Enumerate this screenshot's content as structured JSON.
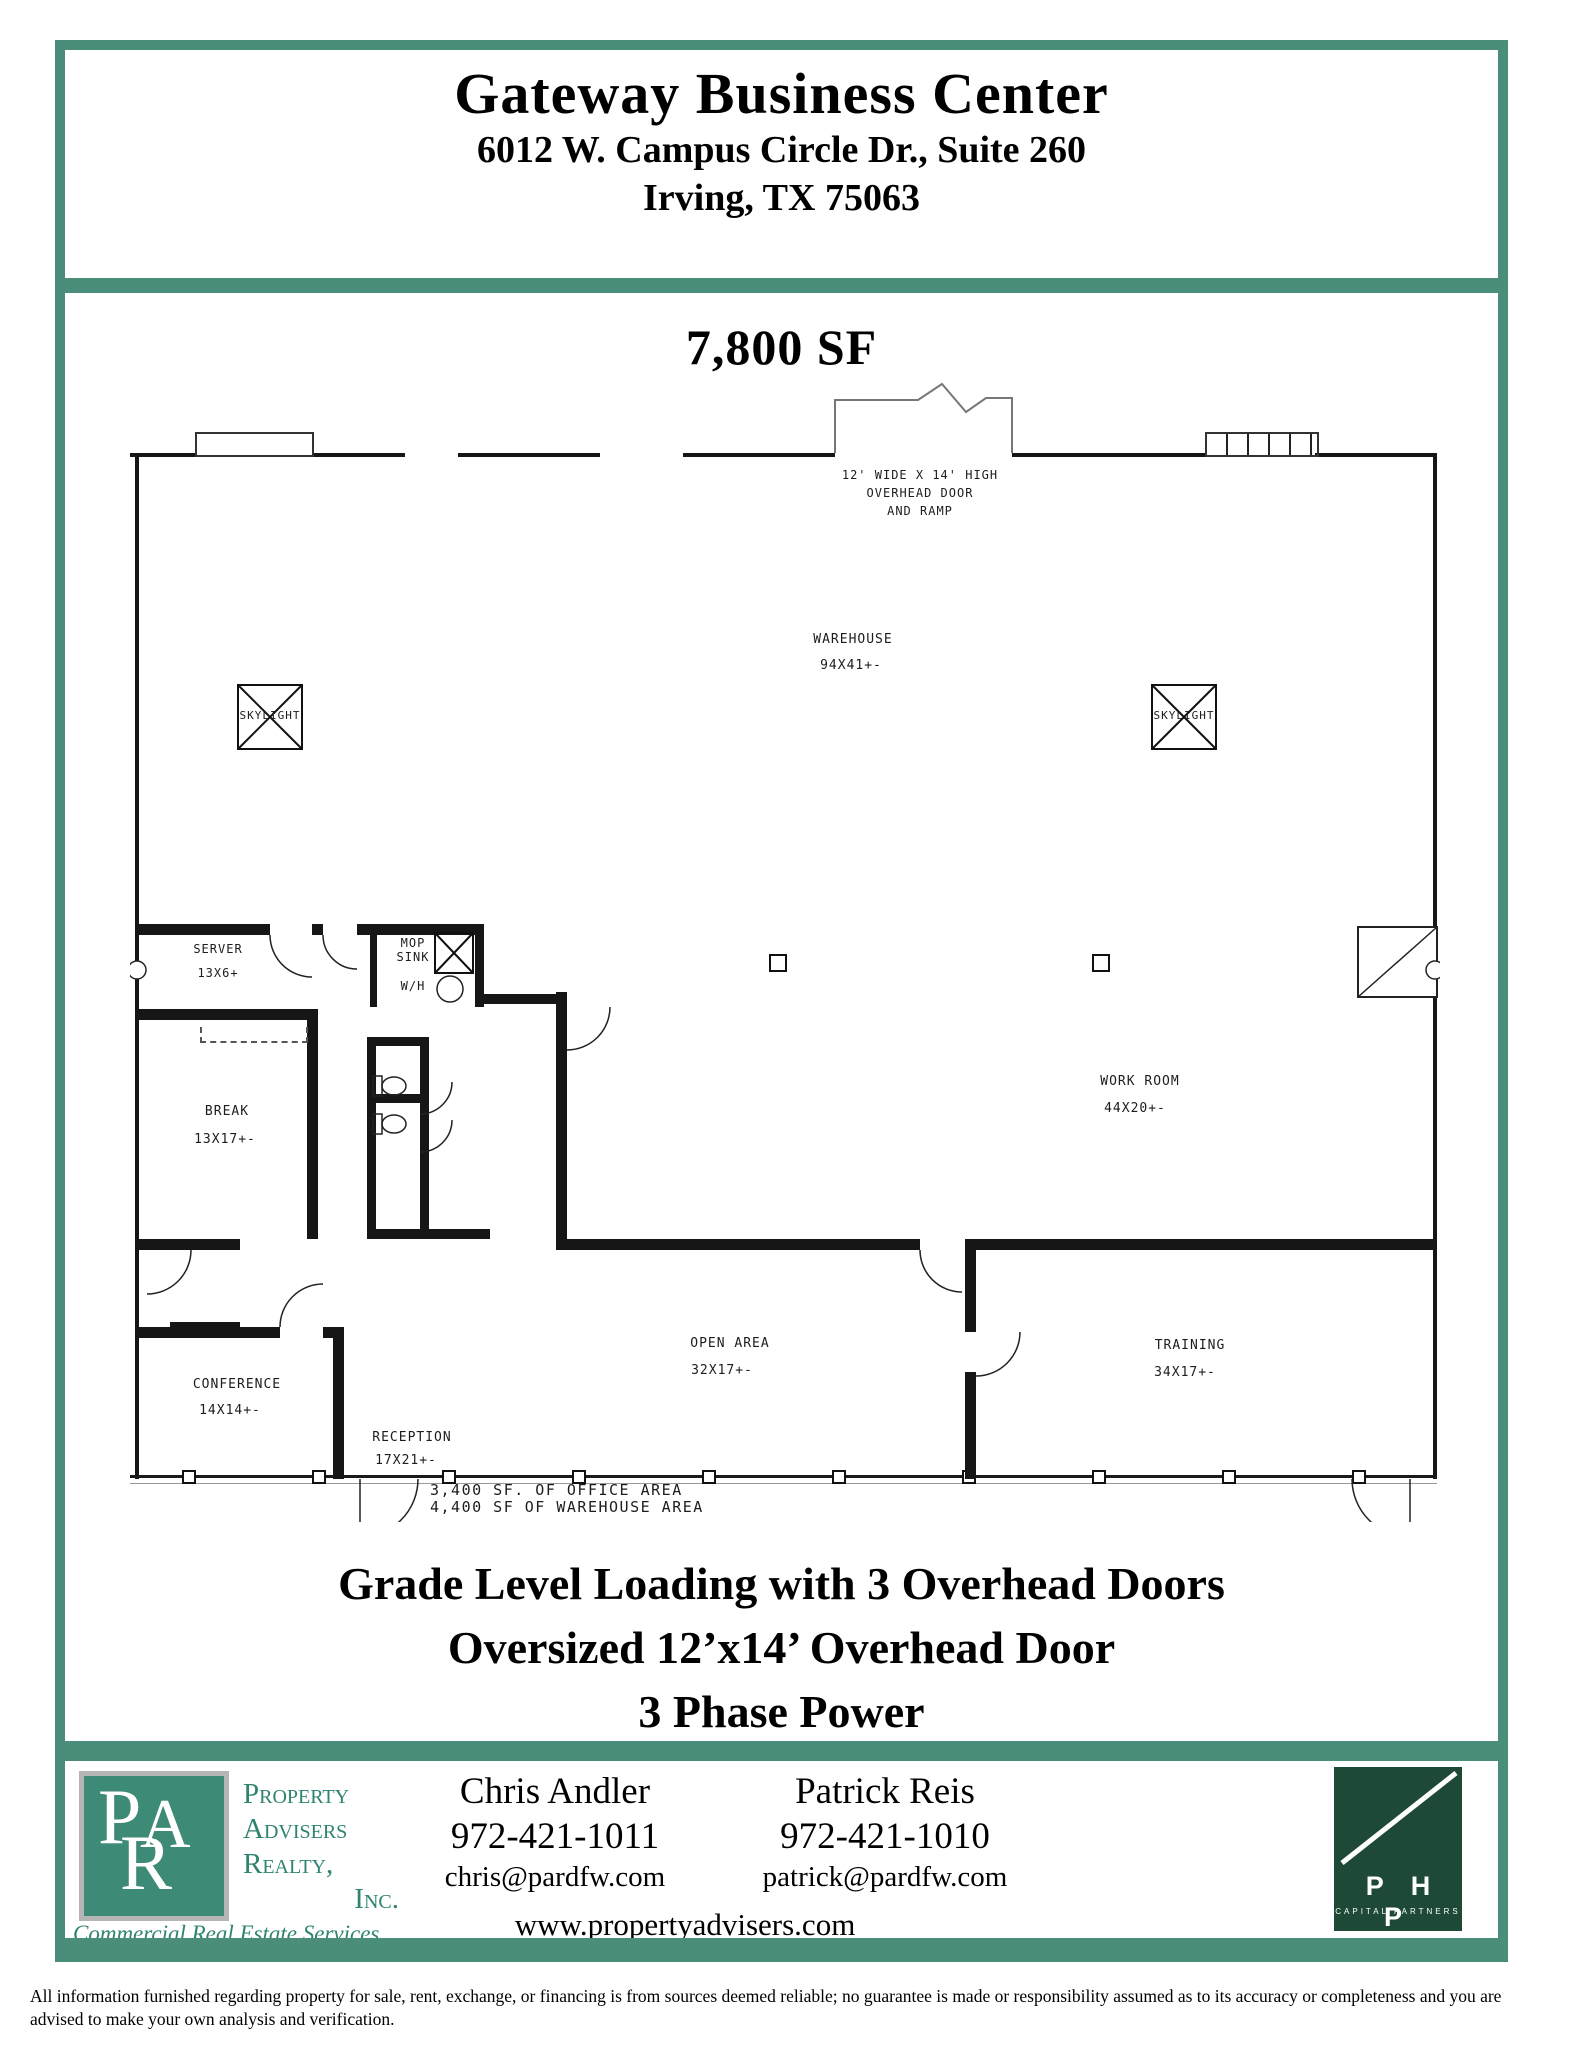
{
  "header": {
    "title": "Gateway Business Center",
    "address_line1": "6012 W. Campus Circle Dr., Suite 260",
    "address_line2": "Irving, TX 75063"
  },
  "plan": {
    "size_heading": "7,800 SF",
    "overhead_note": [
      "12' WIDE X 14' HIGH",
      "OVERHEAD DOOR",
      "AND RAMP"
    ],
    "skylight_label": "SKYLIGHT",
    "mop_label_line1": "MOP",
    "mop_label_line2": "SINK",
    "water_heater_label": "W/H",
    "rooms": [
      {
        "name": "WAREHOUSE",
        "dims": "94X41+-"
      },
      {
        "name": "SERVER",
        "dims": "13X6+"
      },
      {
        "name": "BREAK",
        "dims": "13X17+-"
      },
      {
        "name": "WORK ROOM",
        "dims": "44X20+-"
      },
      {
        "name": "OPEN AREA",
        "dims": "32X17+-"
      },
      {
        "name": "TRAINING",
        "dims": "34X17+-"
      },
      {
        "name": "CONFERENCE",
        "dims": "14X14+-"
      },
      {
        "name": "RECEPTION",
        "dims": "17X21+-"
      }
    ],
    "area_note_line1": "3,400 SF. OF OFFICE AREA",
    "area_note_line2": "4,400 SF OF WAREHOUSE AREA"
  },
  "features": [
    "Grade Level Loading with 3 Overhead Doors",
    "Oversized 12’x14’ Overhead Door",
    "3 Phase Power"
  ],
  "footer": {
    "par": {
      "m1": "P",
      "m2": "A",
      "m3": "R",
      "name_line1": "Property",
      "name_line2": "Advisers",
      "name_line3": "Realty,",
      "name_line4": "Inc.",
      "tagline": "Commercial Real Estate Services"
    },
    "contacts": [
      {
        "name": "Chris Andler",
        "phone": "972-421-1011",
        "email": "chris@pardfw.com"
      },
      {
        "name": "Patrick Reis",
        "phone": "972-421-1010",
        "email": "patrick@pardfw.com"
      }
    ],
    "website": "www.propertyadvisers.com",
    "php": {
      "name": "P H P",
      "subtitle": "CAPITAL PARTNERS"
    }
  },
  "disclaimer": "All information furnished regarding property for sale, rent, exchange, or financing is from sources deemed reliable; no guarantee is made or responsibility assumed as to its accuracy or completeness and you are advised to make your own analysis and verification.",
  "colors": {
    "frame_teal": "#4a8d7b",
    "php_green": "#1d4936",
    "par_teal": "#3d8a76"
  }
}
